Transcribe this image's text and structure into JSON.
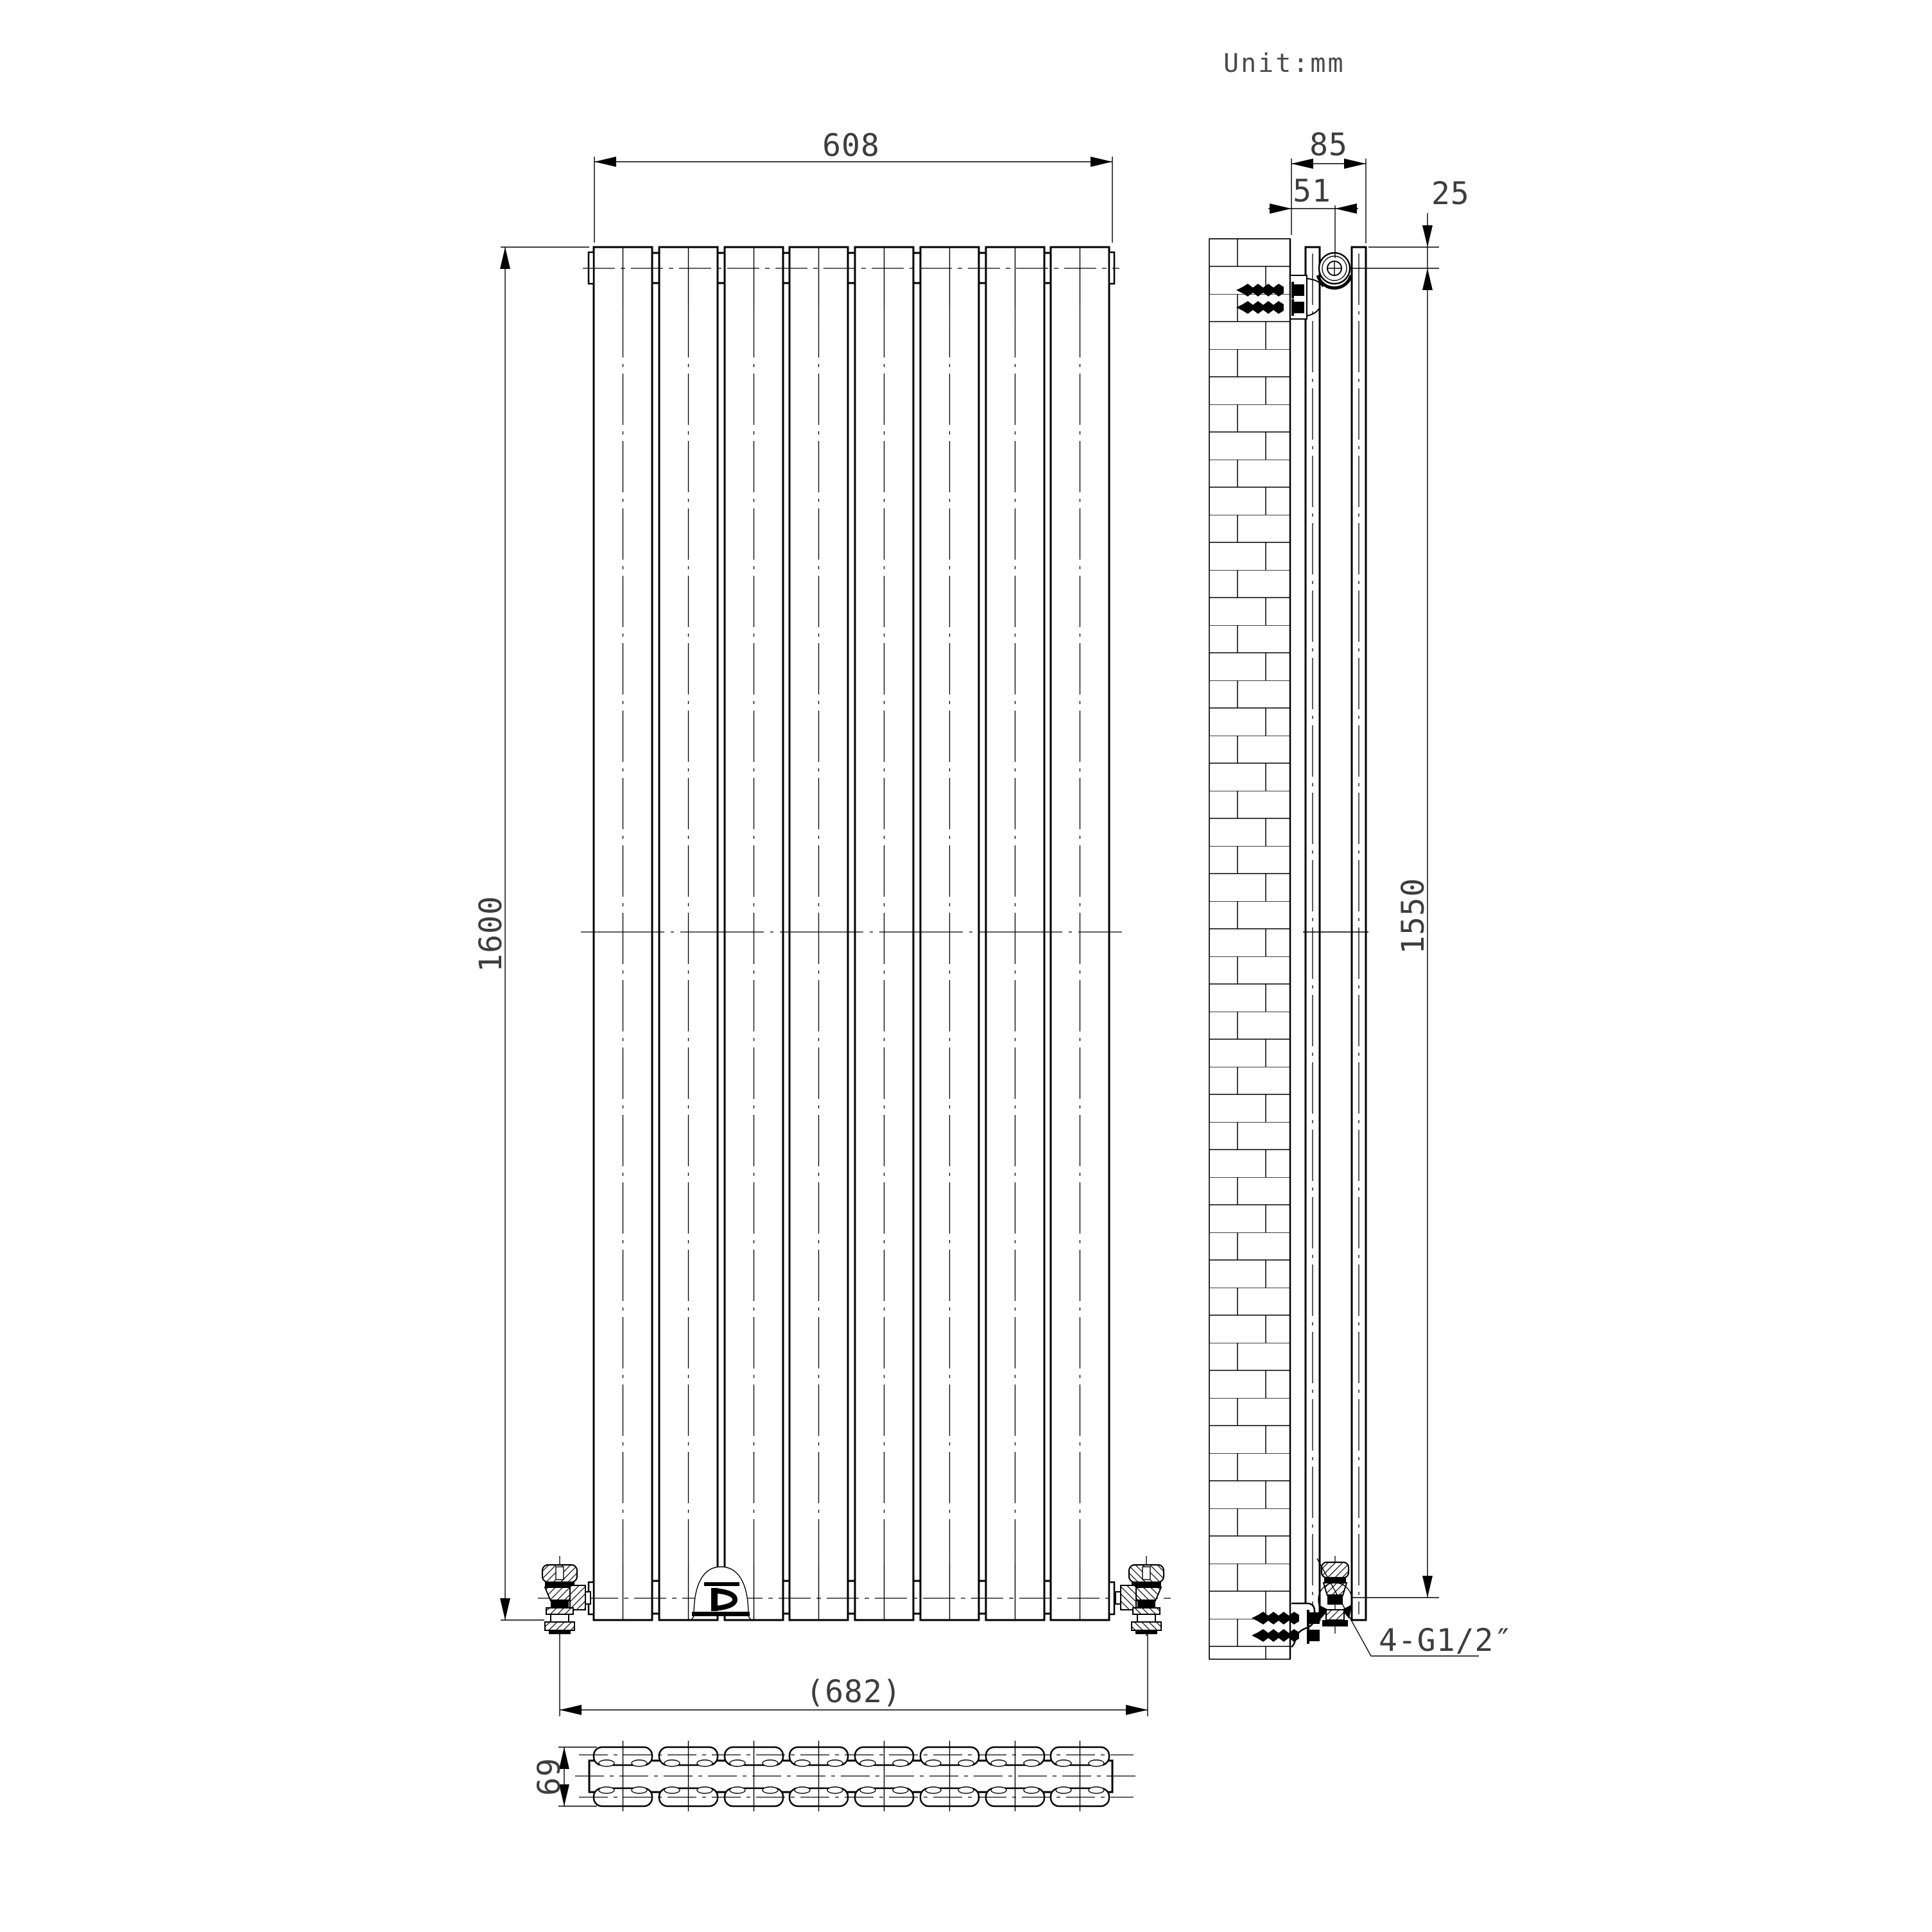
{
  "title_note": {
    "unit": "Unit:mm"
  },
  "front_view": {
    "panel_count": 8,
    "dim_width": "608",
    "dim_height": "1600",
    "dim_valve_centers": "(682)"
  },
  "side_view": {
    "dim_depth_from_wall": "85",
    "dim_bracket_from_wall": "51",
    "dim_top_to_bracket_center": "25",
    "dim_bracket_span": "1550",
    "thread_note": "4-G1/2″"
  },
  "top_view": {
    "dim_depth": "69"
  },
  "style": {
    "line_color": "#000000",
    "dim_text_color": "#3d3d3d",
    "background": "#ffffff"
  }
}
